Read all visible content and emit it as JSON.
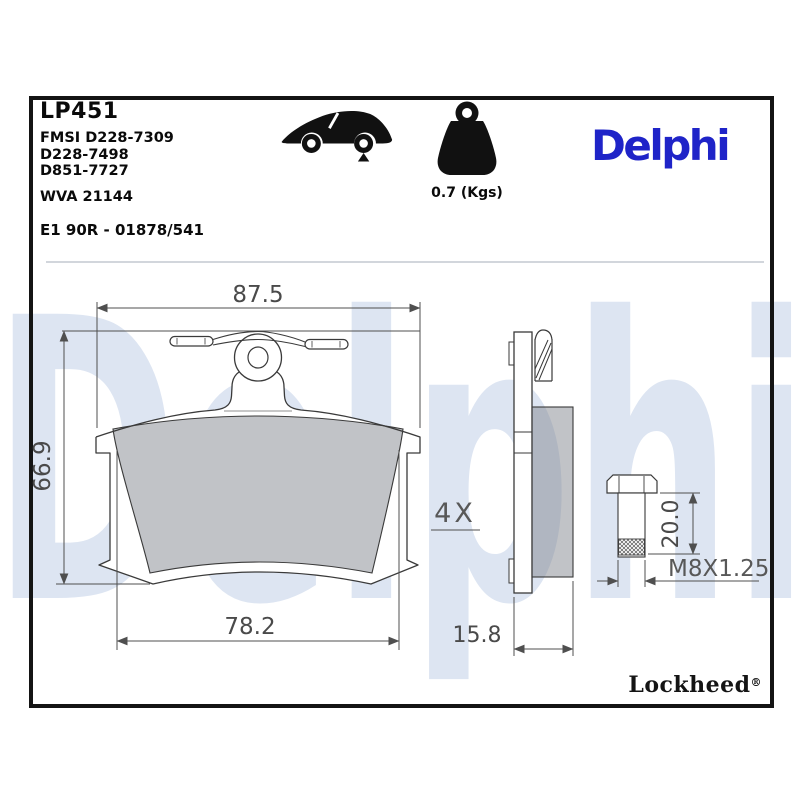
{
  "title_block": {
    "part_number": "LP451",
    "fmsi_lines": [
      "FMSI D228-7309",
      "D228-7498",
      "D851-7727"
    ],
    "wva": "WVA 21144",
    "approval": "E1 90R - 01878/541"
  },
  "header_icons": {
    "car": "car-rear-axle-icon",
    "weight": "weight-kg-icon",
    "weight_label": "0.7 (Kgs)"
  },
  "brand": {
    "name": "Delphi",
    "color": "#1F24C8"
  },
  "watermark": "Delphi",
  "footer": {
    "brand": "Lockheed",
    "registered": "®"
  },
  "drawing": {
    "front_view": {
      "width_mm": "87.5",
      "height_mm": "66.9",
      "pad_width_mm": "78.2"
    },
    "side_view": {
      "thickness_mm": "15.8",
      "quantity_label": "4X"
    },
    "bolt": {
      "length_mm": "20.0",
      "thread_spec": "M8X1.25"
    },
    "colors": {
      "friction_gray": "#c6c8ca",
      "watermark_blue": "#dde5f2",
      "line_gray": "#3a3a3a"
    }
  }
}
